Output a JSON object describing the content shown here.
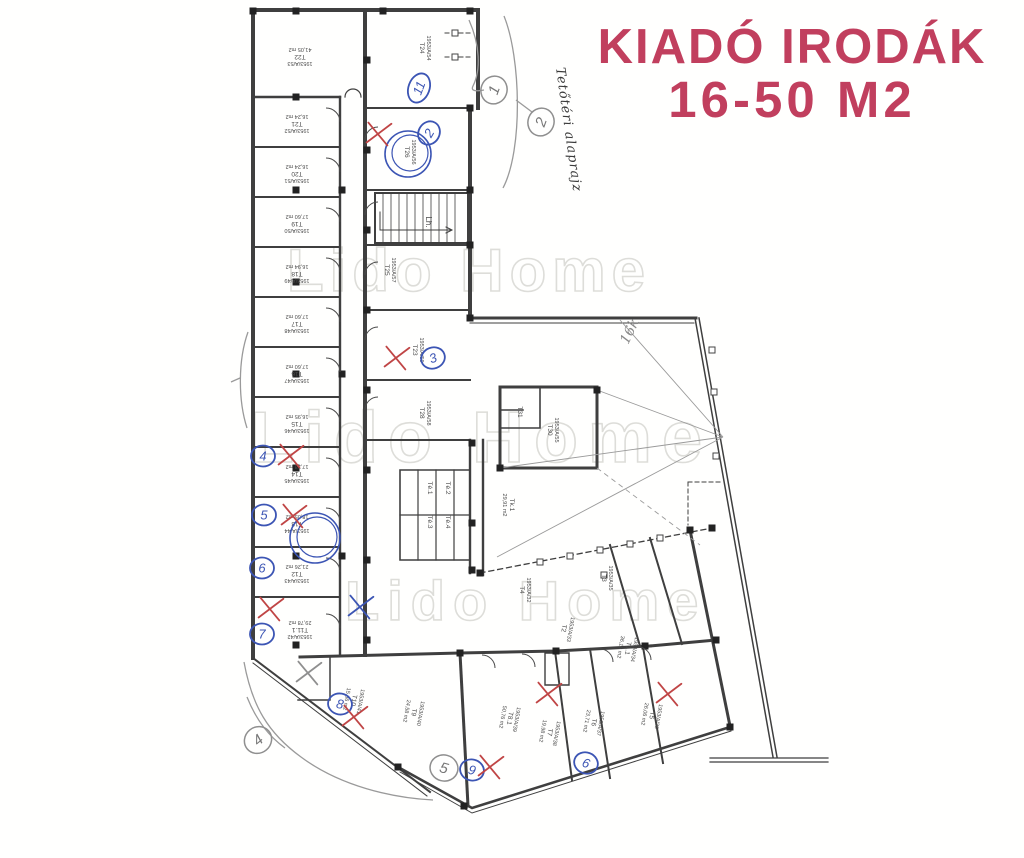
{
  "header": {
    "title_line1": "KIADÓ IRODÁK",
    "title_line2": "16-50 M2",
    "title_color": "#c13f5e"
  },
  "watermark": {
    "text": "Lido Home",
    "color": "#d8d8d3",
    "instances": [
      {
        "x": 287,
        "y": 291,
        "size": 60,
        "ls": 6
      },
      {
        "x": 250,
        "y": 462,
        "size": 72,
        "ls": 10
      },
      {
        "x": 345,
        "y": 620,
        "size": 56,
        "ls": 8
      }
    ]
  },
  "plan": {
    "caption_handwritten": "Tetőtéri alaprajz",
    "note_handwritten": "16k",
    "stairs_label": "Lh.",
    "ink_color": "#3f3f3f",
    "pen_blue": "#3c55b4",
    "pen_red": "#c04545",
    "pencil_gray": "#8f8f8f",
    "units": [
      {
        "room": "T22",
        "parcel": "1953/A/53",
        "area": "41,05 m2",
        "x": 300,
        "y": 55,
        "rot": 180
      },
      {
        "room": "T21",
        "parcel": "1953/A/52",
        "area": "16,24 m2",
        "x": 297,
        "y": 122,
        "rot": 180
      },
      {
        "room": "T20",
        "parcel": "1953/A/51",
        "area": "16,24 m2",
        "x": 297,
        "y": 172,
        "rot": 180
      },
      {
        "room": "T19",
        "parcel": "1953/A/50",
        "area": "17,60 m2",
        "x": 297,
        "y": 222,
        "rot": 180
      },
      {
        "room": "T18",
        "parcel": "1953/A/49",
        "area": "16,94 m2",
        "x": 297,
        "y": 272,
        "rot": 180
      },
      {
        "room": "T17",
        "parcel": "1953/A/48",
        "area": "17,60 m2",
        "x": 297,
        "y": 322,
        "rot": 180
      },
      {
        "room": "T16",
        "parcel": "1953/A/47",
        "area": "17,60 m2",
        "x": 297,
        "y": 372,
        "rot": 180
      },
      {
        "room": "T15",
        "parcel": "1953/A/46",
        "area": "16,95 m2",
        "x": 297,
        "y": 422,
        "rot": 180
      },
      {
        "room": "T14",
        "parcel": "1953/A/45",
        "area": "17,38 m2",
        "x": 297,
        "y": 472,
        "rot": 180
      },
      {
        "room": "T13",
        "parcel": "1953/A/44",
        "area": "18,05 m2",
        "x": 297,
        "y": 522,
        "rot": 180
      },
      {
        "room": "T12",
        "parcel": "1953/A/43",
        "area": "21,26 m2",
        "x": 297,
        "y": 572,
        "rot": 180
      },
      {
        "room": "T11.1",
        "parcel": "1953/A/42",
        "area": "29,78 m2",
        "x": 300,
        "y": 628,
        "rot": 180
      },
      {
        "room": "T24",
        "parcel": "1953/A/54",
        "area": "",
        "x": 420,
        "y": 48,
        "rot": 90
      },
      {
        "room": "T26",
        "parcel": "1953/A/56",
        "area": "",
        "x": 405,
        "y": 152,
        "rot": 90
      },
      {
        "room": "T25",
        "parcel": "1953/A/57",
        "area": "",
        "x": 385,
        "y": 270,
        "rot": 90
      },
      {
        "room": "T23",
        "parcel": "1953/A/59",
        "area": "",
        "x": 413,
        "y": 350,
        "rot": 90
      },
      {
        "room": "T28",
        "parcel": "1953/A/58",
        "area": "",
        "x": 420,
        "y": 413,
        "rot": 90
      },
      {
        "room": "Té.1",
        "parcel": "",
        "area": "",
        "x": 428,
        "y": 488,
        "rot": 90
      },
      {
        "room": "Té.2",
        "parcel": "",
        "area": "",
        "x": 446,
        "y": 488,
        "rot": 90
      },
      {
        "room": "Té.3",
        "parcel": "",
        "area": "",
        "x": 428,
        "y": 522,
        "rot": 90
      },
      {
        "room": "Té.4",
        "parcel": "",
        "area": "",
        "x": 446,
        "y": 522,
        "rot": 90
      },
      {
        "room": "Tk.1",
        "parcel": "",
        "area": "29,91 m2",
        "x": 510,
        "y": 505,
        "rot": 90
      },
      {
        "room": "T31",
        "parcel": "",
        "area": "",
        "x": 518,
        "y": 412,
        "rot": 90
      },
      {
        "room": "T30",
        "parcel": "1953/A/55",
        "area": "",
        "x": 548,
        "y": 430,
        "rot": 90
      },
      {
        "room": "T4",
        "parcel": "1953/A/32",
        "area": "",
        "x": 520,
        "y": 590,
        "rot": 90
      },
      {
        "room": "T3",
        "parcel": "1953/A/35",
        "area": "",
        "x": 602,
        "y": 578,
        "rot": 90
      },
      {
        "room": "T2",
        "parcel": "1953/A/33",
        "area": "",
        "x": 562,
        "y": 628,
        "rot": 100
      },
      {
        "room": "T1.1",
        "parcel": "1953/A/34",
        "area": "36,16 m2",
        "x": 626,
        "y": 648,
        "rot": 100
      },
      {
        "room": "T10",
        "parcel": "1953/A/41",
        "area": "15,86 m2",
        "x": 352,
        "y": 700,
        "rot": 100
      },
      {
        "room": "T9",
        "parcel": "1953/A/40",
        "area": "24,58 m2",
        "x": 412,
        "y": 712,
        "rot": 100
      },
      {
        "room": "T8.1",
        "parcel": "1953/A/39",
        "area": "50,76 m2",
        "x": 508,
        "y": 718,
        "rot": 100
      },
      {
        "room": "T7",
        "parcel": "1953/A/38",
        "area": "19,98 m2",
        "x": 548,
        "y": 732,
        "rot": 100
      },
      {
        "room": "T6",
        "parcel": "1953/A/37",
        "area": "23,71 m2",
        "x": 592,
        "y": 722,
        "rot": 100
      },
      {
        "room": "T5",
        "parcel": "1953/A/36",
        "area": "26,06 m2",
        "x": 650,
        "y": 715,
        "rot": 100
      }
    ],
    "annotations": {
      "blue_circled_numbers": [
        {
          "label": "11",
          "x": 419,
          "y": 88,
          "rot": -70
        },
        {
          "label": "2",
          "x": 429,
          "y": 133,
          "rot": -60
        },
        {
          "label": "3",
          "x": 433,
          "y": 358,
          "rot": -20
        },
        {
          "label": "4",
          "x": 263,
          "y": 456,
          "rot": 0
        },
        {
          "label": "5",
          "x": 264,
          "y": 515,
          "rot": 0
        },
        {
          "label": "6",
          "x": 262,
          "y": 568,
          "rot": 0
        },
        {
          "label": "7",
          "x": 262,
          "y": 634,
          "rot": 0
        },
        {
          "label": "8",
          "x": 340,
          "y": 704,
          "rot": 10
        },
        {
          "label": "9",
          "x": 472,
          "y": 770,
          "rot": 15
        },
        {
          "label": "6",
          "x": 586,
          "y": 763,
          "rot": 20
        }
      ],
      "blue_rings": [
        {
          "x": 408,
          "y": 154,
          "r": 23
        },
        {
          "x": 315,
          "y": 538,
          "r": 25
        }
      ],
      "pencil_circled_numbers": [
        {
          "label": "1",
          "x": 494,
          "y": 90,
          "rot": -70
        },
        {
          "label": "2",
          "x": 541,
          "y": 122,
          "rot": -70
        },
        {
          "label": "4",
          "x": 258,
          "y": 740,
          "rot": -40
        },
        {
          "label": "5",
          "x": 444,
          "y": 768,
          "rot": 15
        }
      ],
      "red_x_marks": [
        {
          "x": 378,
          "y": 133
        },
        {
          "x": 396,
          "y": 357
        },
        {
          "x": 290,
          "y": 455
        },
        {
          "x": 293,
          "y": 515
        },
        {
          "x": 270,
          "y": 608
        },
        {
          "x": 354,
          "y": 716
        },
        {
          "x": 548,
          "y": 693
        },
        {
          "x": 668,
          "y": 693
        },
        {
          "x": 490,
          "y": 766
        }
      ],
      "pencil_x_marks": [
        {
          "x": 308,
          "y": 672
        }
      ],
      "blue_x_marks": [
        {
          "x": 360,
          "y": 606
        }
      ]
    }
  }
}
